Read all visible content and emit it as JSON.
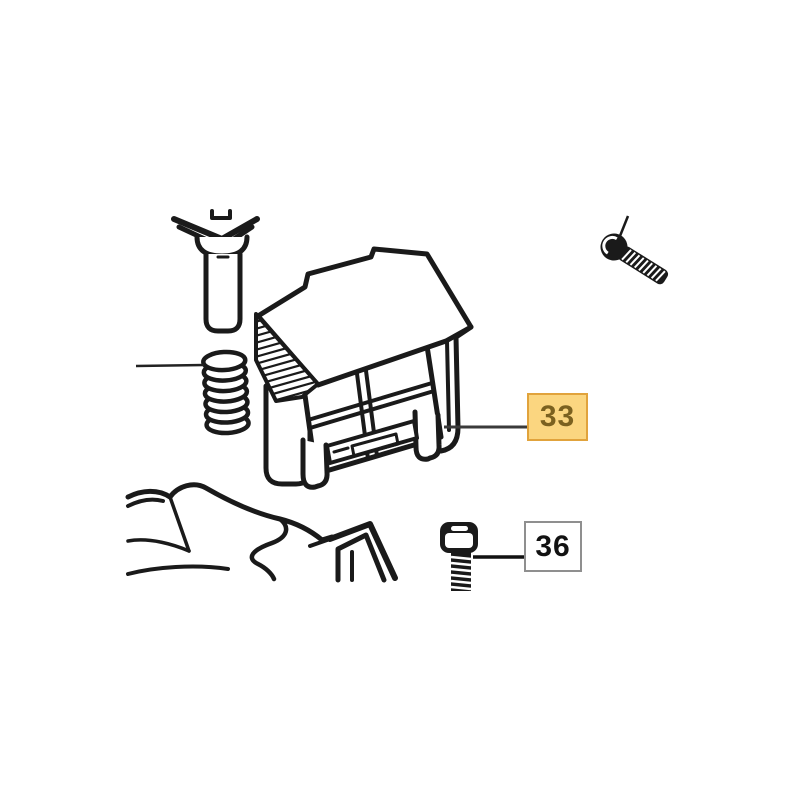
{
  "page": {
    "background": "#ffffff"
  },
  "diagram": {
    "type": "exploded-parts-view",
    "line_color": "#1a1a1a",
    "leader_color": "#333333",
    "callouts": {
      "part33": {
        "label": "33",
        "selected": true,
        "fill": "#fbd680",
        "border": "#e1a33c",
        "text_color": "#7b611f"
      },
      "part36": {
        "label": "36",
        "selected": false,
        "fill": "#ffffff",
        "border": "#8f8f8f",
        "text_color": "#121212"
      }
    },
    "drawings": [
      {
        "icon": "headed-pin-drawing"
      },
      {
        "icon": "long-socket-screw-drawing"
      },
      {
        "icon": "coil-spring-drawing"
      },
      {
        "icon": "latch-block-drawing"
      },
      {
        "icon": "housing-top-drawing"
      },
      {
        "icon": "short-socket-screw-drawing"
      }
    ]
  }
}
